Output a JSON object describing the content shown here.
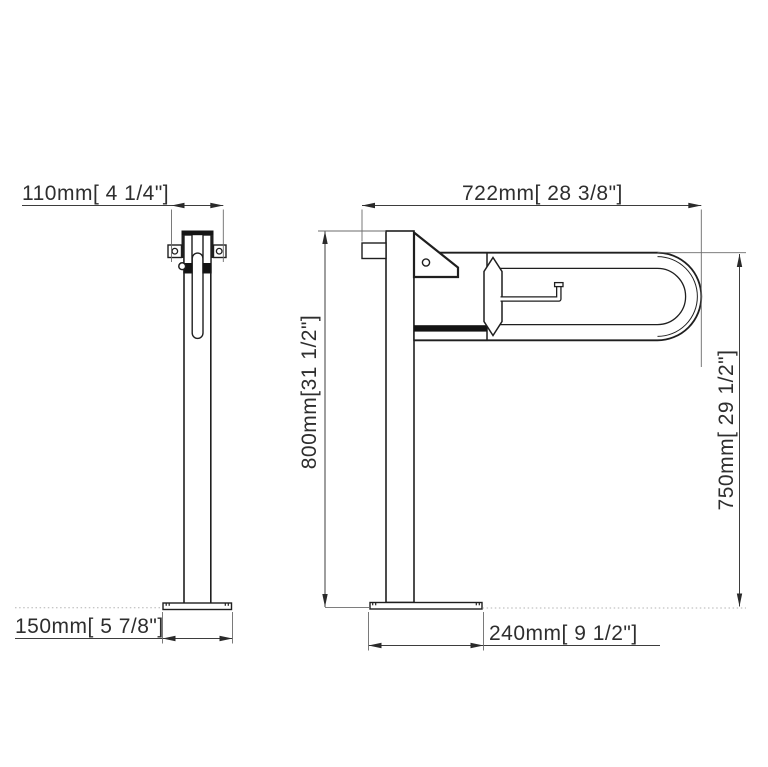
{
  "canvas": {
    "background": "#ffffff",
    "line_color": "#1f1f1f",
    "dimension_line_color": "#3d3d3d"
  },
  "dimensions": {
    "bracket_width": {
      "label": "110mm[ 4 1/4\"]"
    },
    "overall_length": {
      "label": "722mm[ 28 3/8\"]"
    },
    "post_height": {
      "label": "800mm[31 1/2\"]"
    },
    "rail_height": {
      "label": "750mm[ 29 1/2\"]"
    },
    "base_width": {
      "label": "150mm[ 5 7/8\"]"
    },
    "base_depth": {
      "label": "240mm[ 9 1/2\"]"
    }
  }
}
